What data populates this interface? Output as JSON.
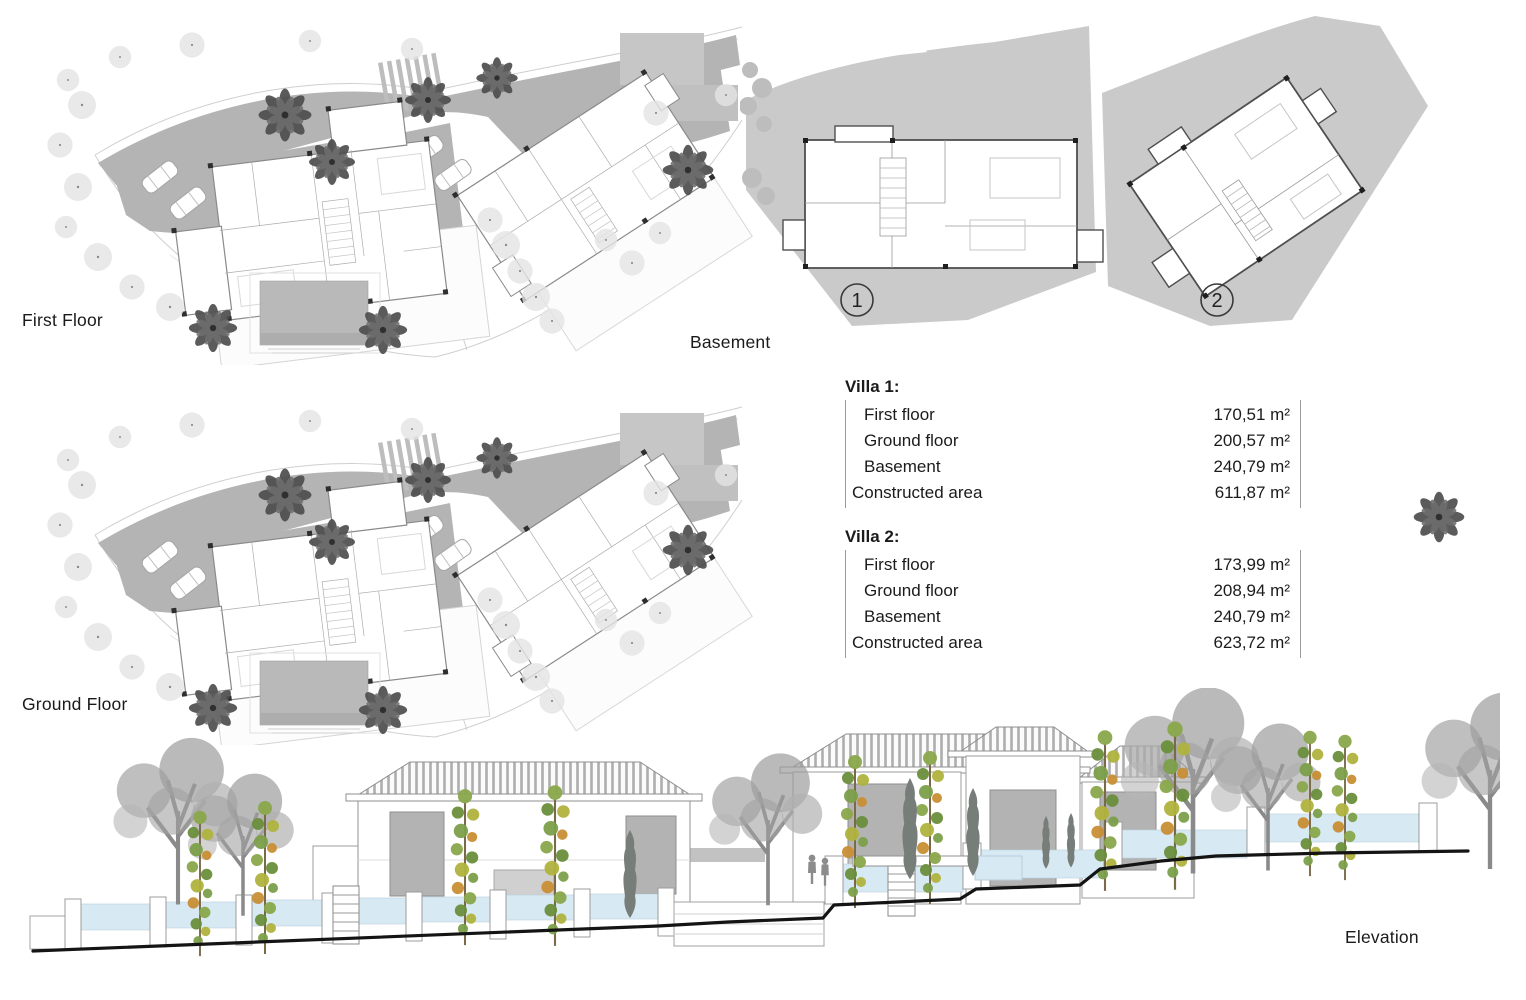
{
  "labels": {
    "first_floor": "First Floor",
    "ground_floor": "Ground Floor",
    "basement": "Basement",
    "elevation": "Elevation"
  },
  "basement": {
    "markers": [
      "1",
      "2"
    ]
  },
  "villas": [
    {
      "title": "Villa 1:",
      "rows": [
        {
          "label": "First floor",
          "value": "170,51 m²"
        },
        {
          "label": "Ground floor",
          "value": "200,57 m²"
        },
        {
          "label": "Basement",
          "value": "240,79 m²"
        },
        {
          "label": "Constructed area",
          "value": "611,87 m²"
        }
      ]
    },
    {
      "title": "Villa 2:",
      "rows": [
        {
          "label": "First floor",
          "value": "173,99 m²"
        },
        {
          "label": "Ground floor",
          "value": "208,94 m²"
        },
        {
          "label": "Basement",
          "value": "240,79 m²"
        },
        {
          "label": "Constructed area",
          "value": "623,72 m²"
        }
      ]
    }
  ],
  "colors": {
    "driveway_gray": "#b4b4b4",
    "basement_gray": "#cacaca",
    "pool_gray": "#b9b9b9",
    "glass_blue": "#d7e9f3",
    "ground_line": "#141414",
    "foliage_green": "#7da04a",
    "foliage_olive": "#b0b43e",
    "foliage_orange": "#c98f35",
    "tree_gray": "#9a9a9a"
  }
}
